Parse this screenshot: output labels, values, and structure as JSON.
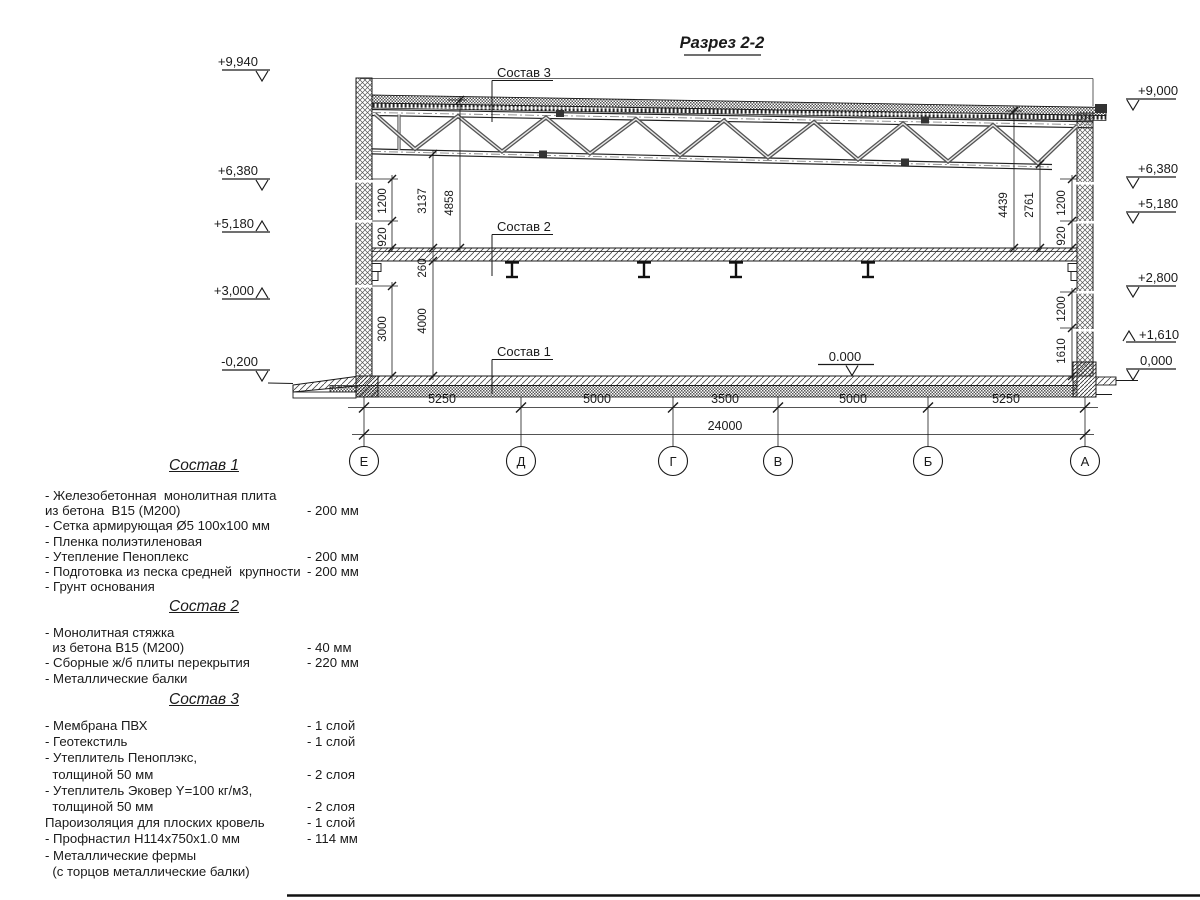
{
  "title": "Разрез 2-2",
  "drawing": {
    "left_marks": [
      "+9,940",
      "+6,380",
      "+5,180",
      "+3,000",
      "-0,200"
    ],
    "right_marks": [
      "+9,000",
      "+6,380",
      "+5,180",
      "+2,800",
      "+1,610",
      "0,000"
    ],
    "floor_zero_mark": "0.000",
    "callout_3": "Состав 3",
    "callout_2": "Состав 2",
    "callout_1": "Состав 1",
    "dims_left": {
      "d1200": "1200",
      "d920": "920",
      "d3137": "3137",
      "d4858": "4858",
      "d260": "260",
      "d4000": "4000",
      "d3000": "3000"
    },
    "dims_right": {
      "d4439": "4439",
      "d2761": "2761",
      "d1200u": "1200",
      "d920": "920",
      "d1200l": "1200",
      "d1610": "1610"
    },
    "axes": [
      "Е",
      "Д",
      "Г",
      "В",
      "Б",
      "А"
    ],
    "spans": [
      "5250",
      "5000",
      "3500",
      "5000",
      "5250"
    ],
    "total_span": "24000"
  },
  "legend": {
    "sections": [
      {
        "heading": "Состав 1",
        "items": [
          {
            "text": "- Железобетонная  монолитная плита",
            "value": ""
          },
          {
            "text": "из бетона  В15 (М200)",
            "value": "- 200 мм"
          },
          {
            "text": "- Сетка армирующая Ø5 100х100 мм",
            "value": ""
          },
          {
            "text": "- Пленка полиэтиленовая",
            "value": ""
          },
          {
            "text": "- Утепление Пеноплекс",
            "value": "- 200 мм"
          },
          {
            "text": "- Подготовка из песка средней  крупности",
            "value": "- 200 мм"
          },
          {
            "text": "- Грунт основания",
            "value": ""
          }
        ]
      },
      {
        "heading": "Состав 2",
        "items": [
          {
            "text": "- Монолитная стяжка",
            "value": ""
          },
          {
            "text": "  из бетона В15 (М200)",
            "value": "- 40 мм"
          },
          {
            "text": "- Сборные ж/б плиты перекрытия",
            "value": "- 220 мм"
          },
          {
            "text": "- Металлические балки",
            "value": ""
          }
        ]
      },
      {
        "heading": "Состав 3",
        "items": [
          {
            "text": "- Мембрана ПВХ",
            "value": "- 1 слой"
          },
          {
            "text": "- Геотекстиль",
            "value": "- 1 слой"
          },
          {
            "text": "- Утеплитель Пеноплэкс,",
            "value": ""
          },
          {
            "text": "  толщиной 50 мм",
            "value": "- 2 слоя"
          },
          {
            "text": "- Утеплитель Эковер Y=100 кг/м3,",
            "value": ""
          },
          {
            "text": "  толщиной 50 мм",
            "value": "- 2 слоя"
          },
          {
            "text": "Пароизоляция для плоских кровель",
            "value": "- 1 слой"
          },
          {
            "text": "- Профнастил Н114х750х1.0 мм",
            "value": "- 114 мм"
          },
          {
            "text": "- Металлические фермы",
            "value": ""
          },
          {
            "text": "  (с торцов металлические балки)",
            "value": ""
          }
        ]
      }
    ]
  }
}
